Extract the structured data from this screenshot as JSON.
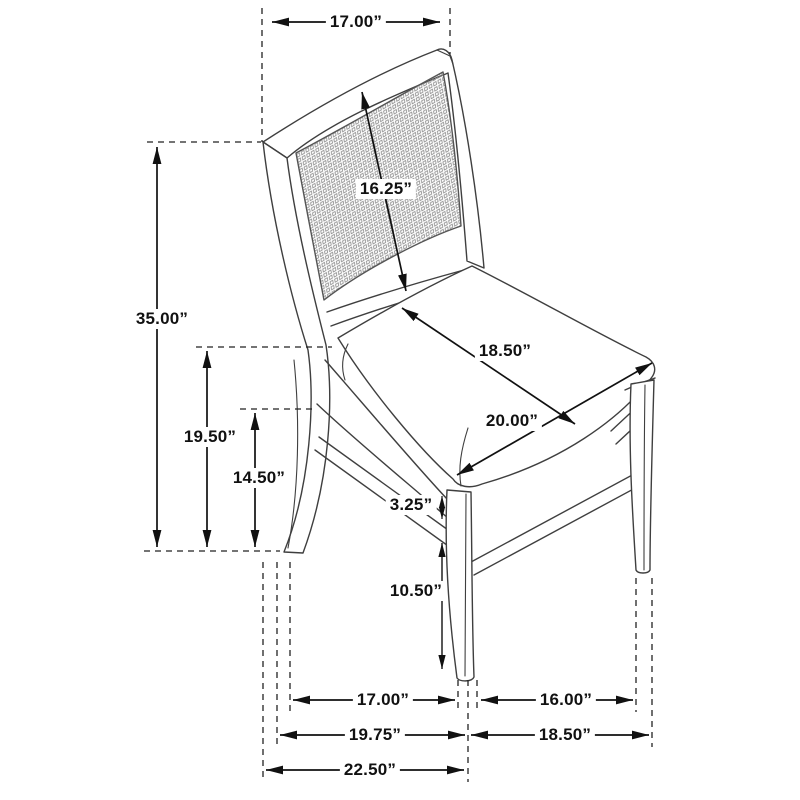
{
  "diagram": {
    "type": "chair-dimension-drawing",
    "unit": "inches",
    "dimensions": {
      "top_width": {
        "label": "17.00”",
        "value": 17.0
      },
      "overall_height": {
        "label": "35.00”",
        "value": 35.0
      },
      "back_panel": {
        "label": "16.25”",
        "value": 16.25
      },
      "seat_width": {
        "label": "18.50”",
        "value": 18.5
      },
      "seat_depth": {
        "label": "20.00”",
        "value": 20.0
      },
      "seat_height": {
        "label": "19.50”",
        "value": 19.5
      },
      "stretcher_height": {
        "label": "14.50”",
        "value": 14.5
      },
      "apron_height": {
        "label": "3.25”",
        "value": 3.25
      },
      "leg_height": {
        "label": "10.50”",
        "value": 10.5
      },
      "floor_span_front": {
        "label": "17.00”",
        "value": 17.0
      },
      "floor_span_side": {
        "label": "16.00”",
        "value": 16.0
      },
      "base_depth": {
        "label": "19.75”",
        "value": 19.75
      },
      "base_width": {
        "label": "18.50”",
        "value": 18.5
      },
      "overall_depth": {
        "label": "22.50”",
        "value": 22.5
      }
    },
    "colors": {
      "line": "#3f3f3f",
      "dimension": "#111111",
      "cane": "#8f8f8f",
      "background": "#ffffff"
    }
  }
}
